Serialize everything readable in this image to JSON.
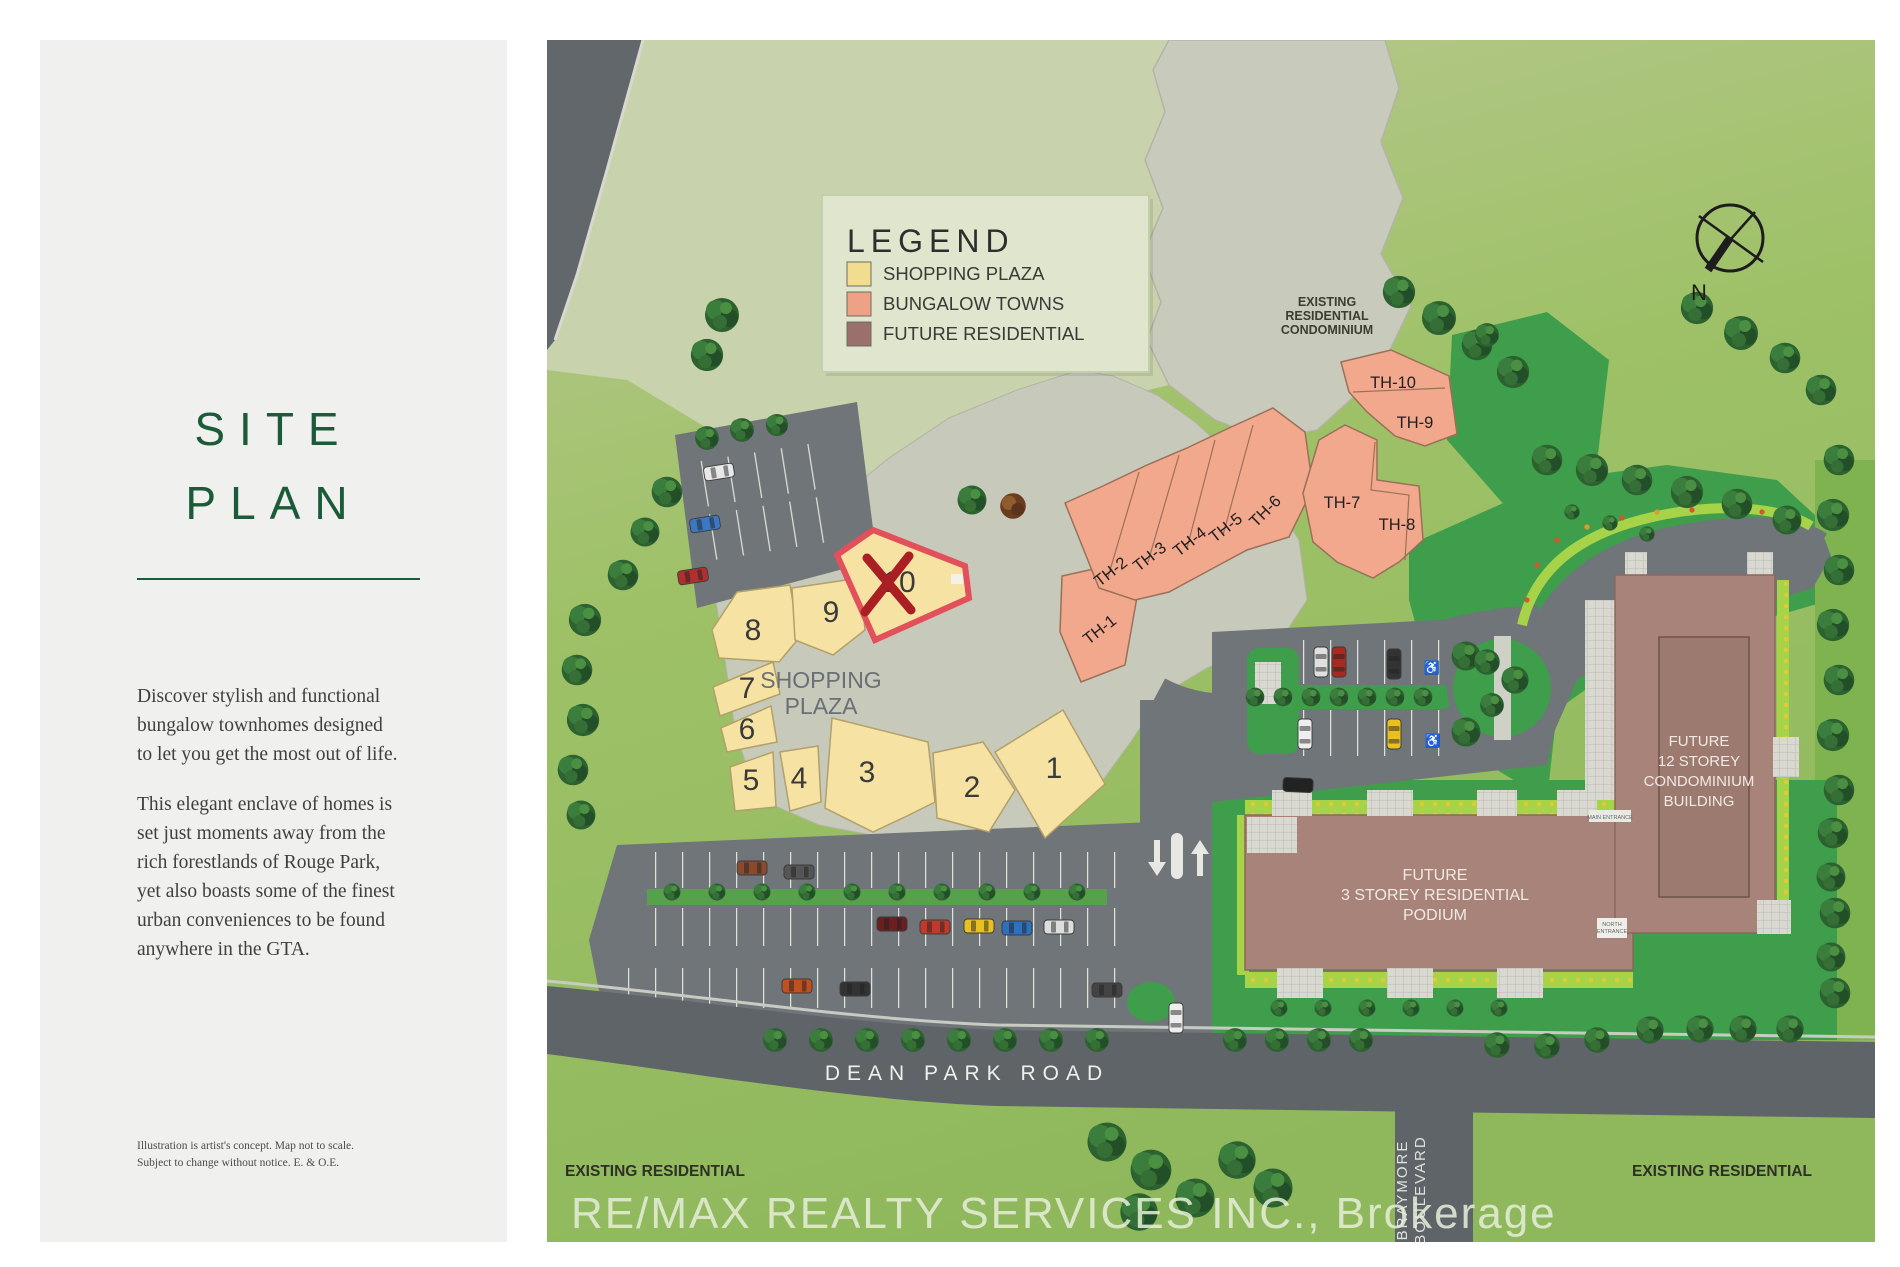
{
  "panel": {
    "title_line1": "SITE",
    "title_line2": "PLAN",
    "paragraph1": "Discover stylish and functional bungalow townhomes designed to let you get the most out of life.",
    "paragraph2": "This elegant enclave of homes is set just moments away from the rich forestlands of Rouge Park, yet also boasts some of the finest urban conveniences to be found anywhere in the GTA.",
    "disclaimer_line1": "Illustration is artist's concept. Map not to scale.",
    "disclaimer_line2": "Subject to change without notice. E. & O.E."
  },
  "legend": {
    "title": "LEGEND",
    "items": [
      {
        "label": "SHOPPING PLAZA",
        "color": "#f2dd8e"
      },
      {
        "label": "BUNGALOW TOWNS",
        "color": "#efa186"
      },
      {
        "label": "FUTURE RESIDENTIAL",
        "color": "#9b6f6b"
      }
    ]
  },
  "map": {
    "compass": "N",
    "existing_condo_line1": "EXISTING",
    "existing_condo_line2": "RESIDENTIAL",
    "existing_condo_line3": "CONDOMINIUM",
    "shopping_plaza_line1": "SHOPPING",
    "shopping_plaza_line2": "PLAZA",
    "plaza_units": [
      "1",
      "2",
      "3",
      "4",
      "5",
      "6",
      "7",
      "8",
      "9"
    ],
    "sold_unit": "10",
    "townhomes": [
      "TH-1",
      "TH-2",
      "TH-3",
      "TH-4",
      "TH-5",
      "TH-6",
      "TH-7",
      "TH-8",
      "TH-9",
      "TH-10"
    ],
    "future_condo_line1": "FUTURE",
    "future_condo_line2": "12 STOREY",
    "future_condo_line3": "CONDOMINIUM",
    "future_condo_line4": "BUILDING",
    "future_podium_line1": "FUTURE",
    "future_podium_line2": "3 STOREY RESIDENTIAL",
    "future_podium_line3": "PODIUM",
    "main_entrance": "MAIN ENTRANCE",
    "north_entrance_line1": "NORTH",
    "north_entrance_line2": "ENTRANCE",
    "dean_park_road": "DEAN PARK ROAD",
    "braymore_line1": "BRAYMORE",
    "braymore_line2": "BOULEVARD",
    "existing_residential_left": "EXISTING RESIDENTIAL",
    "existing_residential_right": "EXISTING RESIDENTIAL",
    "brokerage": "RE/MAX REALTY SERVICES INC., Brokerage"
  },
  "colors": {
    "accent_green": "#1c5b39",
    "shopping_plaza_fill": "#f6e3a3",
    "bungalow_fill": "#f2a88d",
    "future_fill": "#a8837a",
    "sold_outline": "#e2505c",
    "sold_x": "#aa1f24"
  }
}
